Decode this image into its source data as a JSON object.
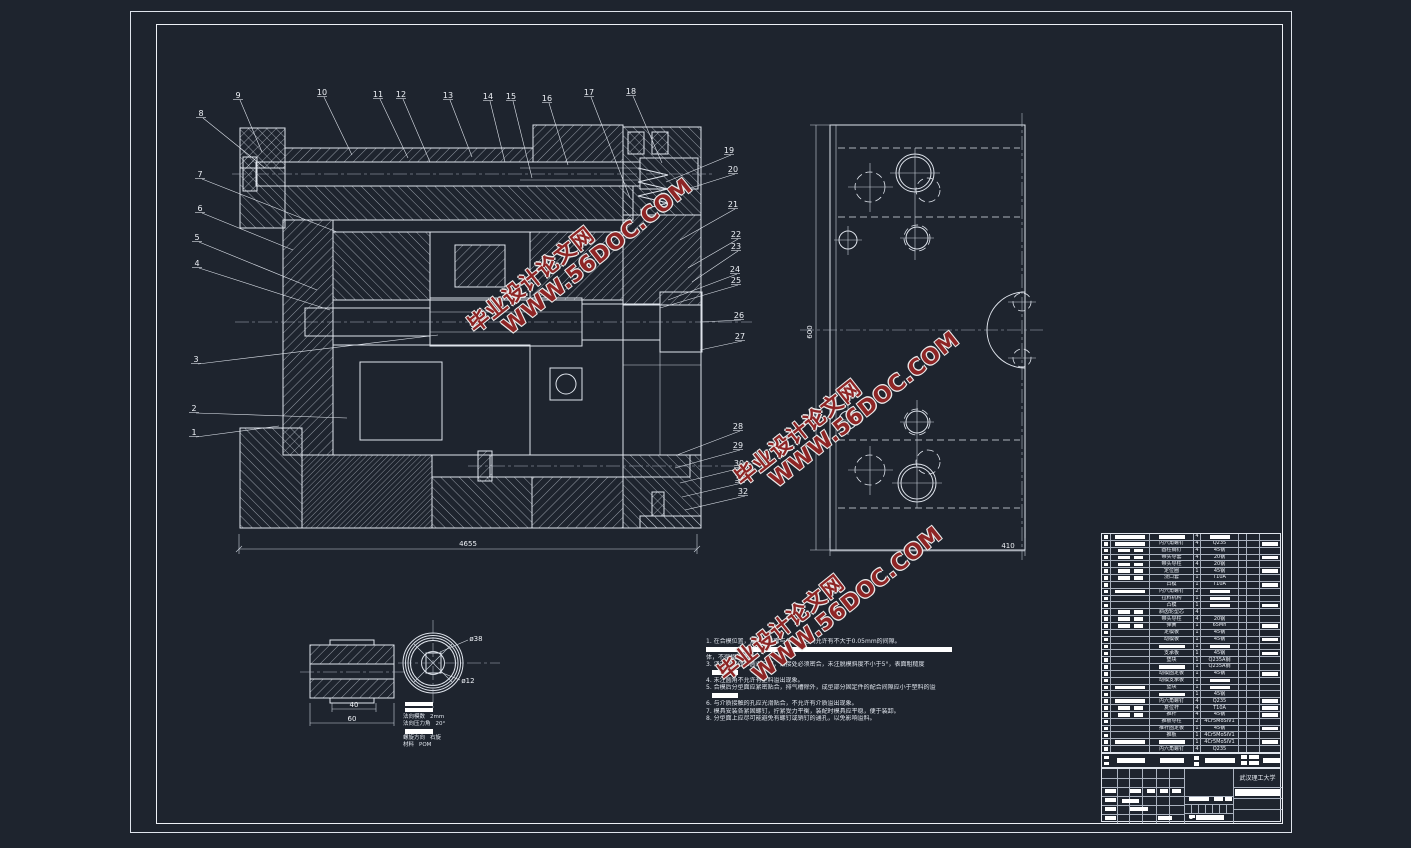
{
  "watermark": {
    "line1": "毕业设计论文网",
    "line2": "WWW.56DOC.COM",
    "color": "#8e2525"
  },
  "dimensions": {
    "main_width": "4655",
    "plan_width": "410",
    "plan_height": "600",
    "detail_inner": "40",
    "detail_outer": "60",
    "gear_outer_dia": "ø38",
    "gear_bore_dia": "ø12"
  },
  "gear_specs": {
    "rows": [
      {
        "label": "法向模数",
        "value": "2mm"
      },
      {
        "label": "法向压力角",
        "value": "20°"
      },
      {
        "label": "螺旋方向",
        "value": "右旋"
      },
      {
        "label": "材料",
        "value": "POM"
      }
    ]
  },
  "notes": [
    {
      "type": "text",
      "text": "1. 在合模位置，复位杆端面与分型面之间允许有不大于0.05mm的间隙。"
    },
    {
      "type": "bar",
      "w": "full"
    },
    {
      "type": "text",
      "text": "体，不得相对窜动。"
    },
    {
      "type": "text",
      "text": "3. 浇道转接处应圆滑过渡，镶接处必须密合，未注脱模斜度不小于5°，表面粗糙度"
    },
    {
      "type": "bar",
      "w": "short"
    },
    {
      "type": "text",
      "text": "4. 未注圆角不允许有塑料溢出现象。"
    },
    {
      "type": "text",
      "text": "5. 合模后分型面应紧密贴合，排气槽除外，成型部分固定件的配合间隙应小于塑料的溢"
    },
    {
      "type": "bar",
      "w": "short"
    },
    {
      "type": "text",
      "text": "6. 与介质接触的孔应光滑贴合，不允许有介质溢出现象。"
    },
    {
      "type": "text",
      "text": "7. 模具安装各紧固螺钉，拧紧受力平衡，装配时模具应平稳，便于装卸。"
    },
    {
      "type": "text",
      "text": "8. 分型面上应尽可能避免有螺钉或销钉的通孔，以免影响溢料。"
    }
  ],
  "balloons": [
    {
      "n": "1",
      "x": 194,
      "y": 435,
      "tx": 279,
      "ty": 426
    },
    {
      "n": "2",
      "x": 194,
      "y": 411,
      "tx": 347,
      "ty": 418
    },
    {
      "n": "3",
      "x": 196,
      "y": 362,
      "tx": 438,
      "ty": 335
    },
    {
      "n": "4",
      "x": 197,
      "y": 266,
      "tx": 330,
      "ty": 310
    },
    {
      "n": "5",
      "x": 197,
      "y": 240,
      "tx": 317,
      "ty": 290
    },
    {
      "n": "6",
      "x": 200,
      "y": 211,
      "tx": 293,
      "ty": 250
    },
    {
      "n": "7",
      "x": 200,
      "y": 177,
      "tx": 337,
      "ty": 232
    },
    {
      "n": "8",
      "x": 201,
      "y": 116,
      "tx": 265,
      "ty": 168
    },
    {
      "n": "9",
      "x": 238,
      "y": 98,
      "tx": 262,
      "ty": 152
    },
    {
      "n": "10",
      "x": 322,
      "y": 95,
      "tx": 352,
      "ty": 155
    },
    {
      "n": "11",
      "x": 378,
      "y": 97,
      "tx": 408,
      "ty": 158
    },
    {
      "n": "12",
      "x": 401,
      "y": 97,
      "tx": 430,
      "ty": 162
    },
    {
      "n": "13",
      "x": 448,
      "y": 98,
      "tx": 472,
      "ty": 157
    },
    {
      "n": "14",
      "x": 488,
      "y": 99,
      "tx": 505,
      "ty": 162
    },
    {
      "n": "15",
      "x": 511,
      "y": 99,
      "tx": 532,
      "ty": 178
    },
    {
      "n": "16",
      "x": 547,
      "y": 101,
      "tx": 568,
      "ty": 165
    },
    {
      "n": "17",
      "x": 589,
      "y": 95,
      "tx": 630,
      "ty": 198
    },
    {
      "n": "18",
      "x": 631,
      "y": 94,
      "tx": 662,
      "ty": 163
    },
    {
      "n": "19",
      "x": 729,
      "y": 153,
      "tx": 666,
      "ty": 182
    },
    {
      "n": "20",
      "x": 733,
      "y": 172,
      "tx": 678,
      "ty": 192
    },
    {
      "n": "21",
      "x": 733,
      "y": 207,
      "tx": 680,
      "ty": 240
    },
    {
      "n": "22",
      "x": 736,
      "y": 237,
      "tx": 688,
      "ty": 268
    },
    {
      "n": "23",
      "x": 736,
      "y": 249,
      "tx": 692,
      "ty": 282
    },
    {
      "n": "24",
      "x": 735,
      "y": 272,
      "tx": 668,
      "ty": 300
    },
    {
      "n": "25",
      "x": 736,
      "y": 283,
      "tx": 660,
      "ty": 308
    },
    {
      "n": "26",
      "x": 739,
      "y": 318,
      "tx": 700,
      "ty": 322
    },
    {
      "n": "27",
      "x": 740,
      "y": 339,
      "tx": 700,
      "ty": 350
    },
    {
      "n": "28",
      "x": 738,
      "y": 429,
      "tx": 677,
      "ty": 455
    },
    {
      "n": "29",
      "x": 738,
      "y": 448,
      "tx": 675,
      "ty": 468
    },
    {
      "n": "30",
      "x": 739,
      "y": 466,
      "tx": 680,
      "ty": 483
    },
    {
      "n": "31",
      "x": 740,
      "y": 481,
      "tx": 682,
      "ty": 497
    },
    {
      "n": "32",
      "x": 743,
      "y": 494,
      "tx": 685,
      "ty": 510
    }
  ],
  "bom": {
    "rows": [
      {
        "c": 1,
        "nh": true,
        "n": "",
        "q": "4",
        "m": "",
        "mh": true,
        "r": false
      },
      {
        "c": 1,
        "n": "内六角螺钉",
        "q": "4",
        "m": "Q235",
        "r": true
      },
      {
        "c": 2,
        "n": "圆柱销钉",
        "q": "4",
        "m": "45钢",
        "r": false
      },
      {
        "c": 2,
        "n": "带头导套",
        "q": "4",
        "m": "20钢",
        "r": true
      },
      {
        "c": 2,
        "n": "带头导柱",
        "q": "4",
        "m": "20钢",
        "r": false
      },
      {
        "c": 2,
        "n": "定位圈",
        "q": "1",
        "m": "45钢",
        "r": true
      },
      {
        "c": 2,
        "n": "浇口套",
        "q": "1",
        "m": "T10A",
        "r": false
      },
      {
        "c": 0,
        "n": "凸模",
        "q": "1",
        "m": "T10A",
        "r": true
      },
      {
        "c": 1,
        "n": "内六角螺钉",
        "q": "2",
        "m": "",
        "mh": true,
        "r": false
      },
      {
        "c": 0,
        "n": "拉料机构",
        "q": "1",
        "m": "",
        "mh": true,
        "r": false
      },
      {
        "c": 0,
        "n": "凸模",
        "q": "1",
        "m": "",
        "mh": true,
        "r": true
      },
      {
        "c": 2,
        "n": "斜齿轮型芯",
        "q": "4",
        "m": "",
        "r": false
      },
      {
        "c": 2,
        "n": "带头导柱",
        "q": "4",
        "m": "20钢",
        "r": false
      },
      {
        "c": 2,
        "n": "弹簧",
        "q": "1",
        "m": "65Mn",
        "r": true
      },
      {
        "c": 0,
        "n": "定模板",
        "q": "1",
        "m": "45钢",
        "r": false
      },
      {
        "c": 0,
        "n": "动模板",
        "q": "1",
        "m": "45钢",
        "r": true
      },
      {
        "c": 0,
        "nh": true,
        "n": "",
        "q": "1",
        "m": "",
        "mh": true,
        "r": false
      },
      {
        "c": 0,
        "n": "支承板",
        "q": "1",
        "m": "45钢",
        "r": true
      },
      {
        "c": 0,
        "n": "垫块",
        "q": "1",
        "m": "Q235A钢",
        "r": false
      },
      {
        "c": 0,
        "nh": true,
        "n": "",
        "q": "1",
        "m": "Q235A钢",
        "r": false
      },
      {
        "c": 0,
        "n": "动模固定板",
        "q": "1",
        "m": "45钢",
        "r": true
      },
      {
        "c": 0,
        "n": "动模支承板",
        "q": "1",
        "m": "",
        "mh": true,
        "r": false
      },
      {
        "c": 1,
        "n": "垫块",
        "q": "1",
        "m": "",
        "mh": true,
        "r": false
      },
      {
        "c": 0,
        "nh": true,
        "n": "",
        "q": "1",
        "m": "45钢",
        "r": false
      },
      {
        "c": 1,
        "n": "内六角螺钉",
        "q": "4",
        "m": "Q235",
        "r": true
      },
      {
        "c": 2,
        "n": "复位杆",
        "q": "4",
        "m": "T10A",
        "r": true
      },
      {
        "c": 2,
        "n": "推杆",
        "q": "4",
        "m": "45钢",
        "r": true
      },
      {
        "c": 0,
        "n": "推板导柱",
        "q": "2",
        "m": "4Cr5MoSiV1",
        "r": false
      },
      {
        "c": 0,
        "n": "推杆固定板",
        "q": "1",
        "m": "45钢",
        "r": true
      },
      {
        "c": 0,
        "n": "推板",
        "q": "1",
        "m": "4Cr5MoSiV1",
        "r": false
      },
      {
        "c": 1,
        "nh": true,
        "n": "",
        "q": "1",
        "m": "4Cr5MoSiV1",
        "r": true
      },
      {
        "c": 0,
        "n": "内六角螺钉",
        "q": "4",
        "m": "Q235",
        "r": false
      }
    ]
  },
  "title_block": {
    "school": "武汉理工大学"
  }
}
